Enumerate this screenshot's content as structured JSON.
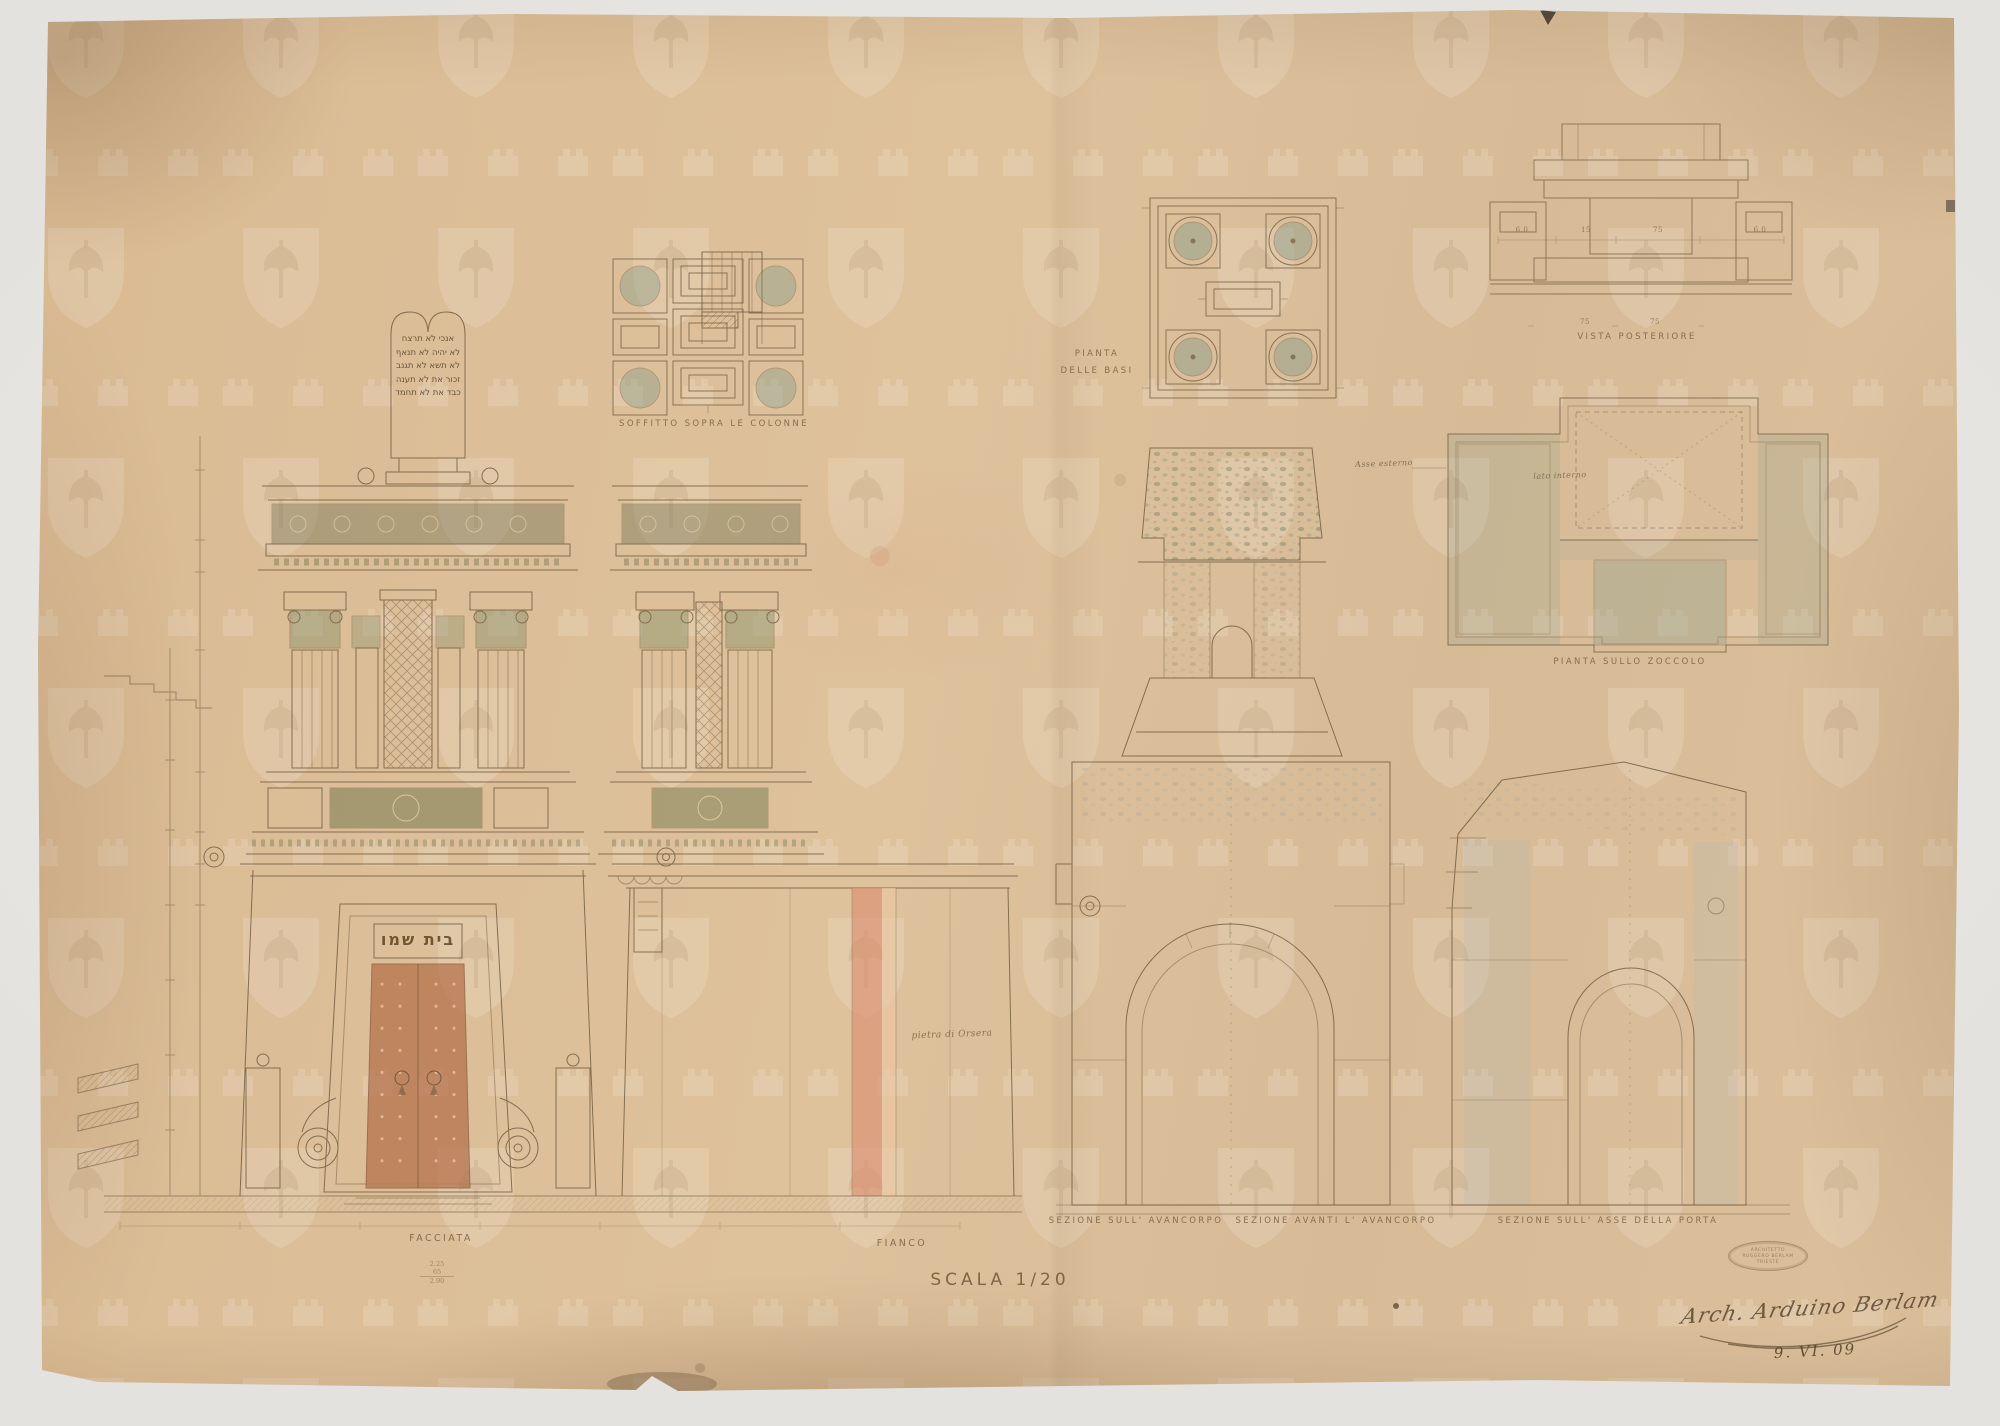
{
  "sheet": {
    "captions": {
      "facciata": "FACCIATA",
      "fianco": "FIANCO",
      "scala": "SCALA 1/20",
      "soffitto": "SOFFITTO SOPRA LE COLONNE",
      "pianta_basi_1": "PIANTA",
      "pianta_basi_2": "DELLE BASI",
      "vista_posteriore": "VISTA POSTERIORE",
      "pianta_zoccolo": "PIANTA SULLO ZOCCOLO",
      "sezione_avancorpo": "SEZIONE SULL' AVANCORPO",
      "sezione_avanti_avancorpo": "SEZIONE AVANTI L' AVANCORPO",
      "sezione_asse_porta": "SEZIONE SULL' ASSE DELLA PORTA"
    },
    "inscriptions": {
      "tablet_lines": [
        "אנכי  לא תרצח",
        "לא יהיה  לא תנאף",
        "לא תשא  לא תגנב",
        "זכור את  לא תענה",
        "כבד את  לא תחמד"
      ],
      "door_lintel": "בית שמו"
    },
    "annotations": {
      "pietra_orsera": "pietra di Orsera",
      "asse_esterno": "Asse esterno",
      "lato_interno": "lato interno",
      "somma": [
        "2.25",
        "65",
        "2.90"
      ],
      "vista_dims_upper": [
        "6.0",
        "15",
        "75",
        "6.0"
      ],
      "vista_dims_lower": [
        "75",
        "75"
      ]
    },
    "colophon": {
      "stamp_line1": "ARCHITETTO",
      "stamp_line2": "RUGGERO BERLAM",
      "stamp_line3": "TRIESTE",
      "autograph": "Arch. Arduino Berlam",
      "date": "9. VI. 09"
    }
  }
}
